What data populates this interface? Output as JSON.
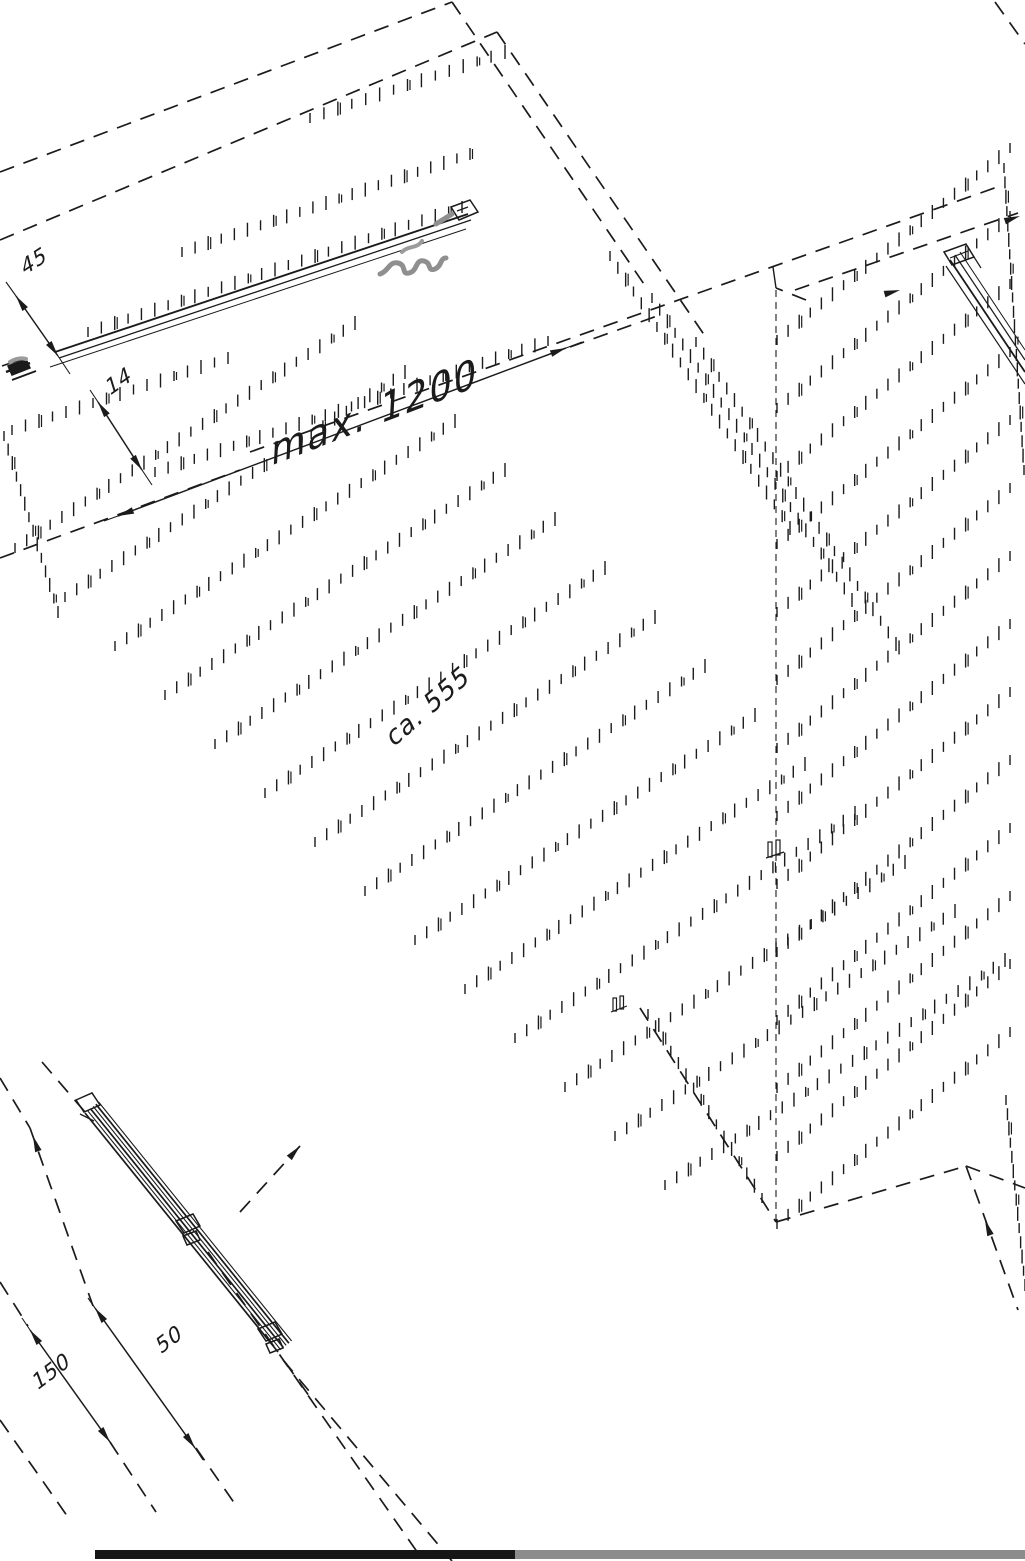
{
  "labels": {
    "top_offset": "45",
    "side_offset": "14",
    "max_spacing": "max. 1200",
    "mid_height": "ca. 555",
    "bottom_spacing_outer": "150",
    "bottom_spacing_inner": "50"
  },
  "colors": {
    "ink": "#1b1b1b",
    "highlight": "#8f8f8f",
    "footer_bar_left": "#161616",
    "footer_bar_right": "#8c8c8c",
    "background": "#ffffff"
  }
}
